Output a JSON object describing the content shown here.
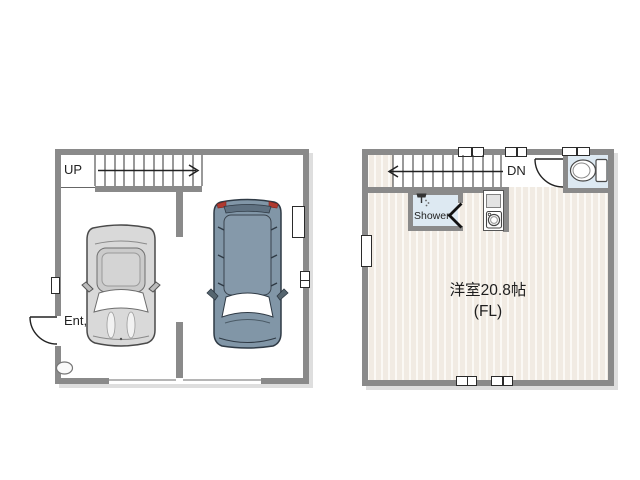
{
  "plan_1f": {
    "up_label": "UP",
    "entrance_label": "Ent,",
    "features": [
      "stairs-up",
      "entrance-door",
      "car-sedan",
      "car-suv",
      "garage-door-opening",
      "windows",
      "step-oval"
    ]
  },
  "plan_2f": {
    "down_label": "DN",
    "shower_label": "Shower",
    "room_label": "洋室20.8帖",
    "room_sublabel": "(FL)",
    "features": [
      "stairs-down",
      "toilet",
      "toilet-door",
      "shower-room",
      "folding-door",
      "washing-machine",
      "windows"
    ]
  },
  "colors": {
    "wall": "#8a8a8a",
    "floor_stripe": "#f1ebe3",
    "wet_room_floor": "#dde9f2",
    "car_sedan_body": "#d9d9d9",
    "car_suv_body": "#8196a7",
    "taillight_red": "#b03a30"
  }
}
